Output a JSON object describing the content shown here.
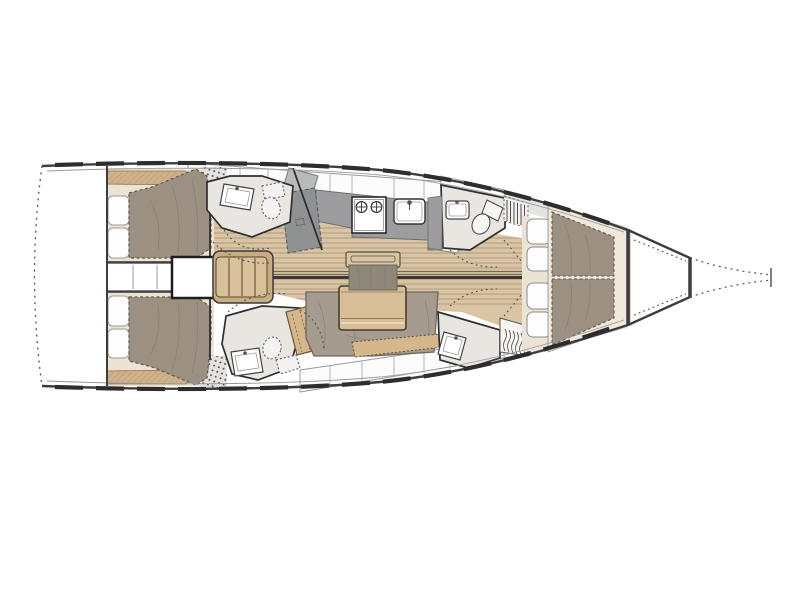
{
  "figure": {
    "title": "Sailboat interior layout — top-down deck plan, bow to the right",
    "type": "boat-floorplan",
    "orientation": "bow-right",
    "description": "Top-down interior layout plan of a sailing yacht: two aft double cabins with pillows and berths, central saloon with L-shaped settee, folding table and centerline bench, linear galley with two-burner stove and sink, navigation module, two aft heads with washbasin, toilet and shower, forward head and forward shower compartment with hanging locker, and a forward owner's cabin with split island berth; dotted swim platform at stern and dotted bowsprit at bow."
  },
  "palette": {
    "paper": "#ffffff",
    "hull": "#3d3d3d",
    "innerline": "#9a9a9a",
    "dark": "#2f2f2f",
    "wood": "#d9c5a4",
    "woodline": "#8d7a5d",
    "woodmid": "#cbb189",
    "tablewood": "#d9bf97",
    "stepwood": "#d8c09a",
    "stepframe": "#c9ad82",
    "shelfwood": "#cfb28a",
    "hatchwood": "#d4b78b",
    "mattress": "#9c9083",
    "settee": "#a59c8f",
    "cushion": "#8e887a",
    "mattressline": "#5f564c",
    "counter": "#9d9da0",
    "navseat": "#8f9193",
    "charttable": "#b9babb",
    "headfloor": "#e9e6e2",
    "bedframe": "#ece3d4",
    "locker": "#fcfcfc",
    "lockerline": "#9a9a9a",
    "deckband": "#e3e3e2",
    "white": "#fdfdfd",
    "centerline": "#3b3731"
  },
  "rooms": [
    {
      "name": "stern-platform",
      "items": [
        "open transom (dotted fold-down swim platform)"
      ]
    },
    {
      "name": "aft-cabin-port",
      "items": [
        "double berth mattress",
        "2 pillows",
        "hull-side wood shelf",
        "shower stipple corner"
      ]
    },
    {
      "name": "aft-cabin-starboard",
      "items": [
        "double berth mattress",
        "2 pillows",
        "hull-side wood shelf",
        "shower stipple corner"
      ]
    },
    {
      "name": "companionway",
      "items": [
        "4-tread companionway steps",
        "engine compartment box",
        "under-cockpit corridor"
      ]
    },
    {
      "name": "galley",
      "items": [
        "two-burner stove",
        "sink with faucet",
        "worktop",
        "overhead lockers",
        "fridge front"
      ]
    },
    {
      "name": "navigation-station",
      "items": [
        "chart table",
        "seat module"
      ]
    },
    {
      "name": "head-aft-port",
      "items": [
        "washbasin",
        "marine toilet",
        "shower stipple"
      ]
    },
    {
      "name": "head-aft-starboard",
      "items": [
        "washbasin",
        "marine toilet",
        "shower stipple",
        "wood step seat"
      ]
    },
    {
      "name": "saloon",
      "items": [
        "L-shaped settee",
        "folding saloon table",
        "centerline bench with cushion",
        "plank floor",
        "section centerline"
      ]
    },
    {
      "name": "head-forward",
      "items": [
        "washbasin",
        "marine toilet"
      ]
    },
    {
      "name": "shower-forward",
      "items": [
        "washbasin",
        "hanging locker with hangers",
        "louvered locker"
      ]
    },
    {
      "name": "forward-cabin",
      "items": [
        "split island double berth",
        "4 seat cushions",
        "forward bulkhead"
      ]
    },
    {
      "name": "bow",
      "items": [
        "anchor locker",
        "dotted stem / bowsprit tip"
      ]
    }
  ]
}
